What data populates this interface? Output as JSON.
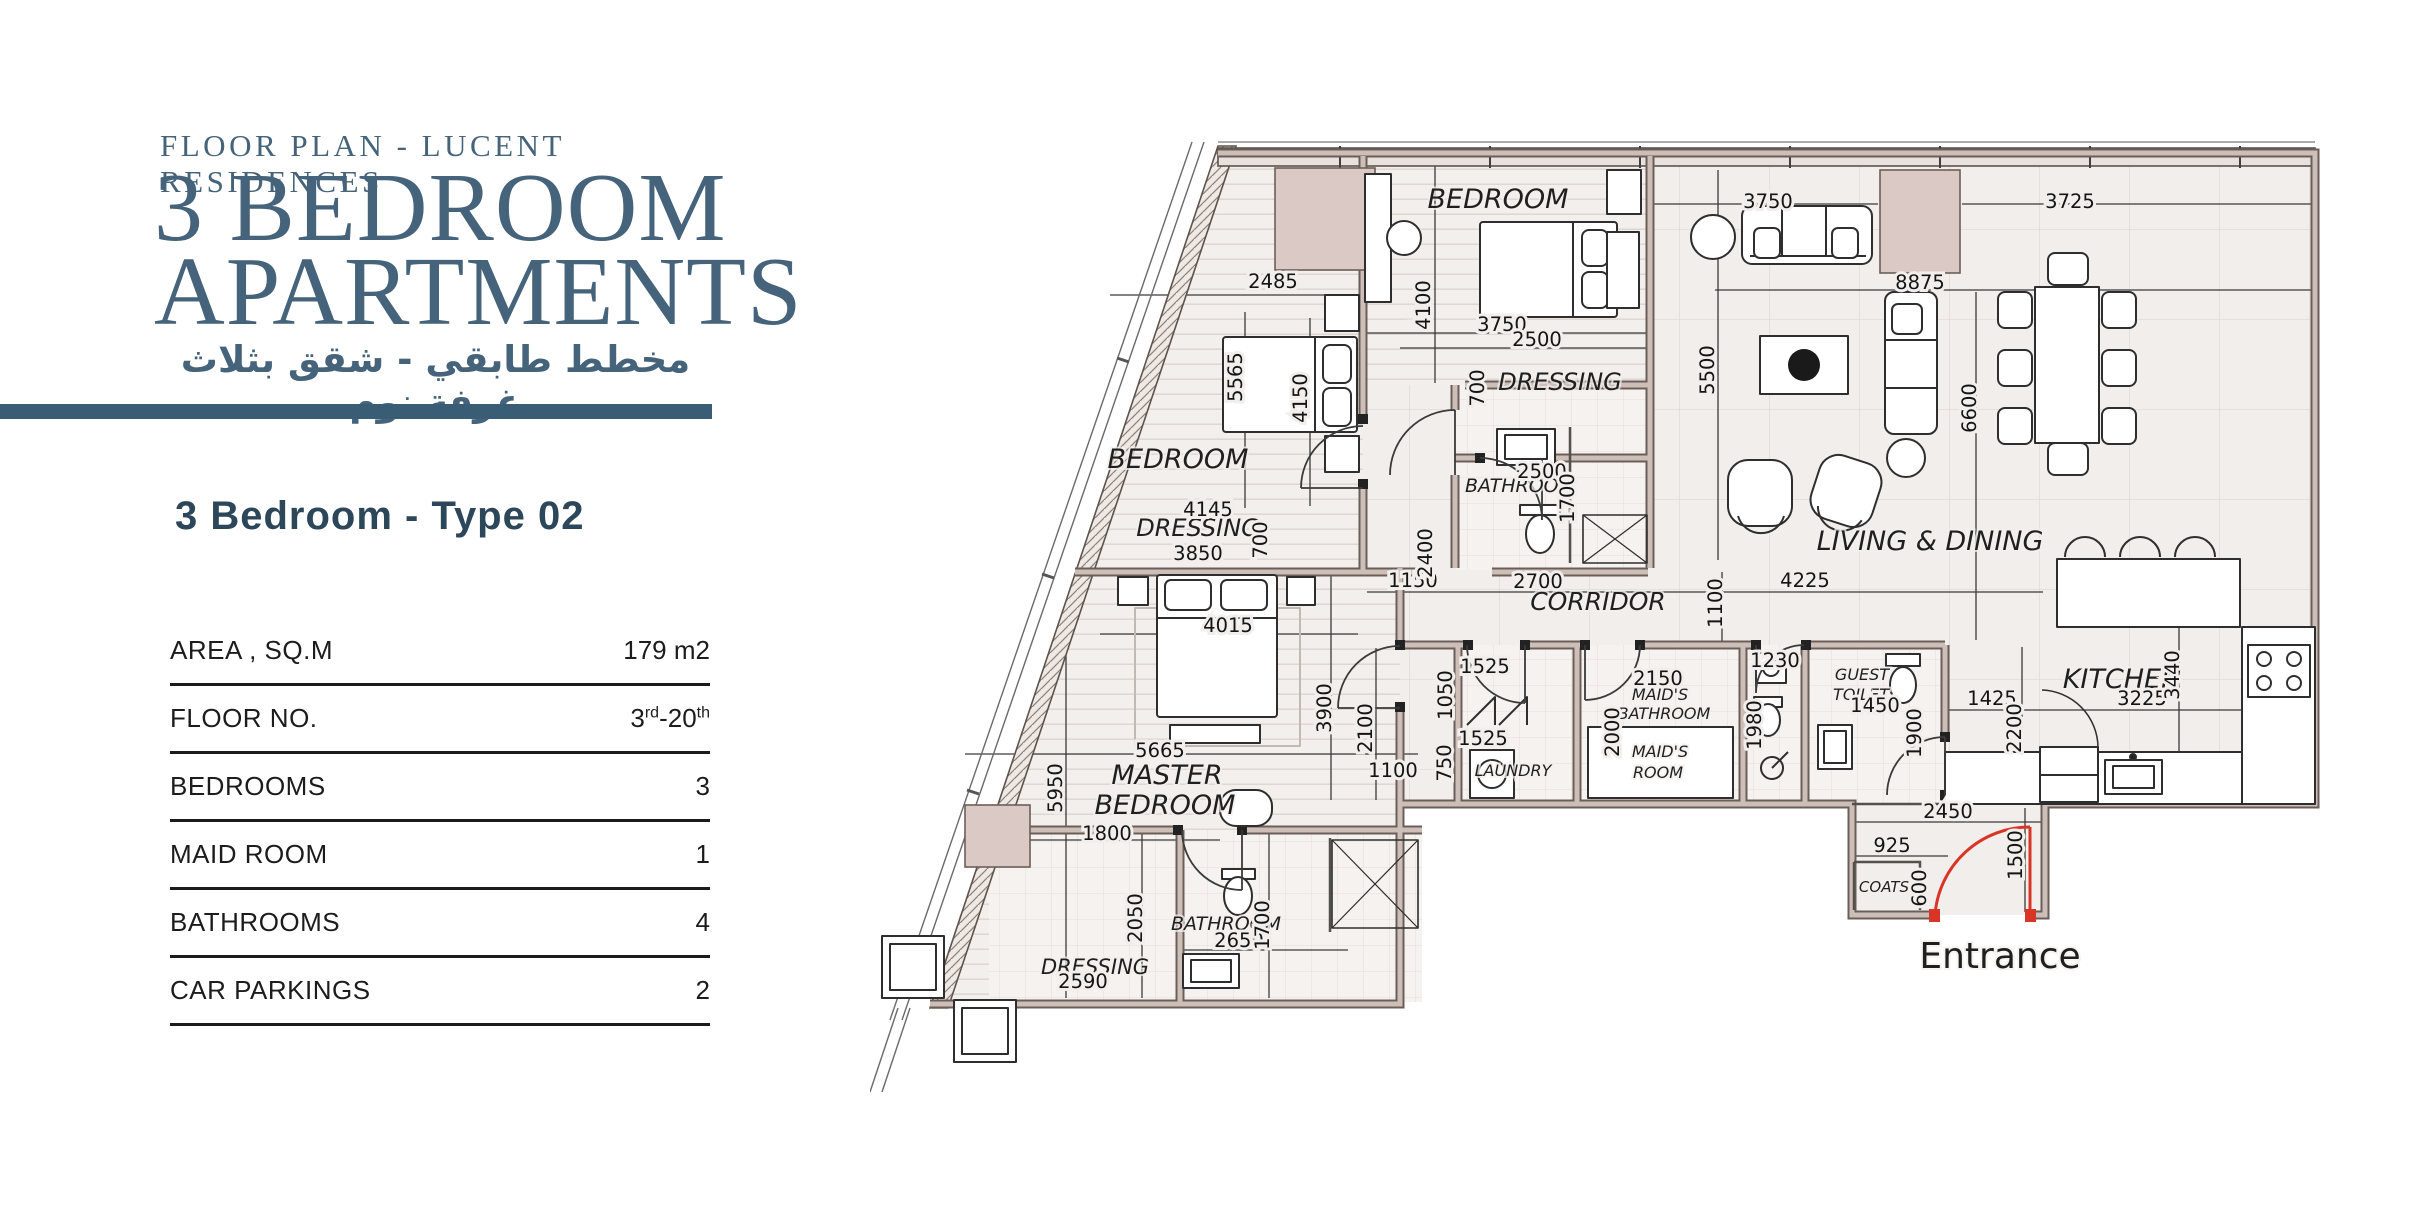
{
  "header": {
    "eyebrow": "FLOOR PLAN - LUCENT RESIDENCES",
    "title_line1": "3 BEDROOM",
    "title_line2": "APARTMENTS",
    "subtitle_ar": "مخطط طابقي - شقق بثلاث غرفة نوم"
  },
  "unit": {
    "title": "3 Bedroom - Type 02"
  },
  "specs": {
    "rows": [
      {
        "label": "AREA , SQ.M",
        "value": "179 m2"
      },
      {
        "label": "FLOOR NO.",
        "value": "3rd-20th",
        "parts": {
          "a": "3",
          "a_sup": "rd",
          "b": "-20",
          "b_sup": "th"
        }
      },
      {
        "label": "BEDROOMS",
        "value": "3"
      },
      {
        "label": "MAID ROOM",
        "value": "1"
      },
      {
        "label": "BATHROOMS",
        "value": "4"
      },
      {
        "label": "CAR PARKINGS",
        "value": "2"
      }
    ]
  },
  "colors": {
    "accent": "#3a5d76",
    "wall_fill": "#cdbeb7",
    "wall_edge": "#6a5f58",
    "shaded_block": "#dbc9c5",
    "entrance_red": "#d93527"
  },
  "plan": {
    "entrance": {
      "t": "Entrance",
      "x": 1130,
      "y": 828,
      "s": 36
    },
    "room_labels": [
      {
        "t": "BEDROOM",
        "x": 628,
        "y": 68,
        "s": 27
      },
      {
        "t": "BEDROOM",
        "x": 308,
        "y": 328,
        "s": 27
      },
      {
        "t": "DRESSING",
        "x": 690,
        "y": 250,
        "s": 24
      },
      {
        "t": "BATHROOM",
        "x": 650,
        "y": 352,
        "s": 19
      },
      {
        "t": "DRESSING",
        "x": 328,
        "y": 396,
        "s": 24
      },
      {
        "t": "LIVING & DINING",
        "x": 1060,
        "y": 410,
        "s": 27
      },
      {
        "t": "CORRIDOR",
        "x": 728,
        "y": 470,
        "s": 25
      },
      {
        "t": "KITCHEN",
        "x": 1252,
        "y": 548,
        "s": 27
      },
      {
        "t": "MASTER",
        "x": 297,
        "y": 644,
        "s": 27
      },
      {
        "t": "BEDROOM",
        "x": 295,
        "y": 674,
        "s": 27
      },
      {
        "t": "LAUNDRY",
        "x": 643,
        "y": 636,
        "s": 16
      },
      {
        "t": "MAID'S",
        "x": 790,
        "y": 560,
        "s": 16
      },
      {
        "t": "BATHROOM",
        "x": 794,
        "y": 579,
        "s": 16
      },
      {
        "t": "MAID'S",
        "x": 790,
        "y": 617,
        "s": 16
      },
      {
        "t": "ROOM",
        "x": 788,
        "y": 638,
        "s": 16
      },
      {
        "t": "GUEST",
        "x": 992,
        "y": 540,
        "s": 16
      },
      {
        "t": "TOILET",
        "x": 991,
        "y": 560,
        "s": 16
      },
      {
        "t": "COATS",
        "x": 1014,
        "y": 752,
        "s": 15
      },
      {
        "t": "DRESSING",
        "x": 225,
        "y": 834,
        "s": 21
      },
      {
        "t": "BATHROOM",
        "x": 356,
        "y": 790,
        "s": 19
      }
    ],
    "dim_labels": [
      {
        "t": "2485",
        "x": 403,
        "y": 148
      },
      {
        "t": "3750",
        "x": 632,
        "y": 191
      },
      {
        "t": "2500",
        "x": 667,
        "y": 206
      },
      {
        "t": "8875",
        "x": 1050,
        "y": 149
      },
      {
        "t": "3750",
        "x": 898,
        "y": 68
      },
      {
        "t": "3725",
        "x": 1200,
        "y": 68
      },
      {
        "t": "4145",
        "x": 338,
        "y": 376
      },
      {
        "t": "3850",
        "x": 328,
        "y": 420
      },
      {
        "t": "4015",
        "x": 358,
        "y": 492
      },
      {
        "t": "5665",
        "x": 290,
        "y": 617
      },
      {
        "t": "1800",
        "x": 237,
        "y": 700
      },
      {
        "t": "2650",
        "x": 369,
        "y": 807
      },
      {
        "t": "2590",
        "x": 213,
        "y": 848
      },
      {
        "t": "1150",
        "x": 543,
        "y": 447
      },
      {
        "t": "2700",
        "x": 668,
        "y": 448
      },
      {
        "t": "4225",
        "x": 935,
        "y": 447
      },
      {
        "t": "1525",
        "x": 615,
        "y": 533
      },
      {
        "t": "1525",
        "x": 613,
        "y": 605
      },
      {
        "t": "1100",
        "x": 523,
        "y": 637
      },
      {
        "t": "2150",
        "x": 788,
        "y": 545
      },
      {
        "t": "1230",
        "x": 905,
        "y": 527
      },
      {
        "t": "1450",
        "x": 1005,
        "y": 572
      },
      {
        "t": "2450",
        "x": 1078,
        "y": 678
      },
      {
        "t": "925",
        "x": 1022,
        "y": 712
      },
      {
        "t": "1425",
        "x": 1122,
        "y": 565
      },
      {
        "t": "3225",
        "x": 1272,
        "y": 565
      },
      {
        "t": "2500",
        "x": 672,
        "y": 338
      },
      {
        "t": "4100",
        "x": 560,
        "y": 165,
        "r": 1
      },
      {
        "t": "5565",
        "x": 372,
        "y": 237,
        "r": 1
      },
      {
        "t": "4150",
        "x": 437,
        "y": 258,
        "r": 1
      },
      {
        "t": "700",
        "x": 614,
        "y": 248,
        "r": 1
      },
      {
        "t": "5500",
        "x": 844,
        "y": 230,
        "r": 1
      },
      {
        "t": "6600",
        "x": 1106,
        "y": 268,
        "r": 1
      },
      {
        "t": "1700",
        "x": 704,
        "y": 358,
        "r": 1
      },
      {
        "t": "2400",
        "x": 562,
        "y": 413,
        "r": 1
      },
      {
        "t": "3900",
        "x": 461,
        "y": 568,
        "r": 1
      },
      {
        "t": "2100",
        "x": 502,
        "y": 588,
        "r": 1
      },
      {
        "t": "1050",
        "x": 582,
        "y": 555,
        "r": 1
      },
      {
        "t": "750",
        "x": 581,
        "y": 623,
        "r": 1
      },
      {
        "t": "2000",
        "x": 749,
        "y": 592,
        "r": 1
      },
      {
        "t": "1980",
        "x": 891,
        "y": 585,
        "r": 1
      },
      {
        "t": "1900",
        "x": 1051,
        "y": 593,
        "r": 1
      },
      {
        "t": "600",
        "x": 1056,
        "y": 748,
        "r": 1
      },
      {
        "t": "1500",
        "x": 1152,
        "y": 715,
        "r": 1
      },
      {
        "t": "2200",
        "x": 1151,
        "y": 588,
        "r": 1
      },
      {
        "t": "3440",
        "x": 1309,
        "y": 535,
        "r": 1
      },
      {
        "t": "5950",
        "x": 192,
        "y": 648,
        "r": 1
      },
      {
        "t": "2050",
        "x": 272,
        "y": 778,
        "r": 1
      },
      {
        "t": "1700",
        "x": 399,
        "y": 785,
        "r": 1
      },
      {
        "t": "700",
        "x": 397,
        "y": 400,
        "r": 1
      },
      {
        "t": "1100",
        "x": 852,
        "y": 463,
        "r": 1
      }
    ]
  }
}
